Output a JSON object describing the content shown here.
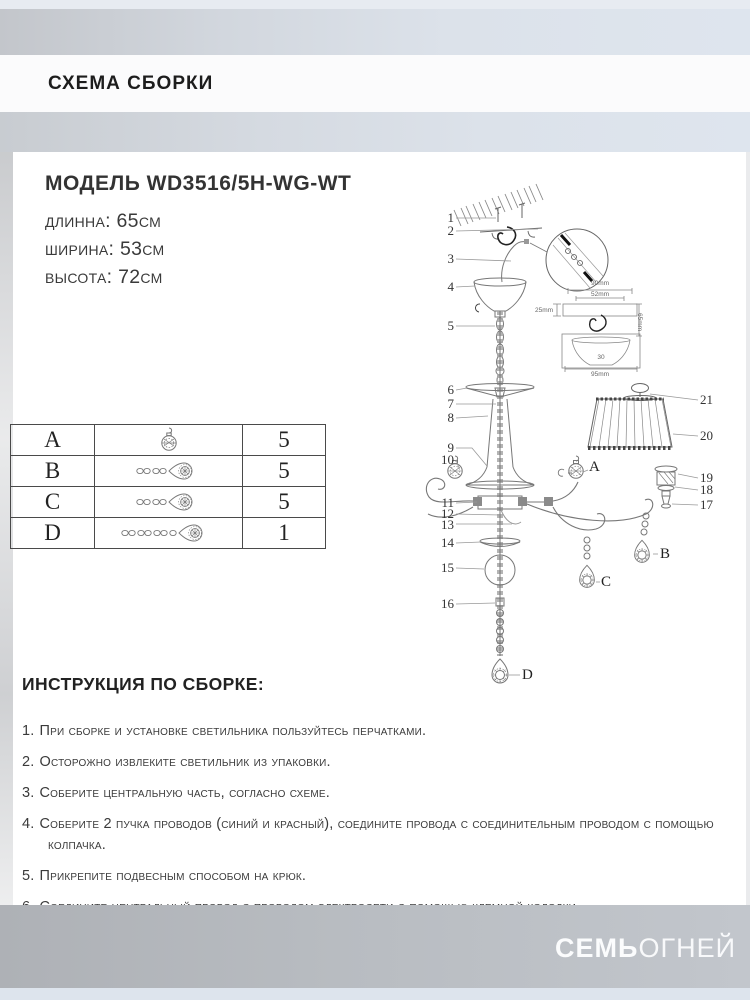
{
  "header": {
    "title": "СХЕМА СБОРКИ"
  },
  "model": {
    "title": "МОДЕЛЬ WD3516/5H-WG-WT",
    "specs": [
      "длинна: 65см",
      "ширина: 53см",
      "высота: 72см"
    ]
  },
  "parts_table": {
    "rows": [
      {
        "letter": "A",
        "icon": "crystal-ball-pendant-icon",
        "qty": "5"
      },
      {
        "letter": "B",
        "icon": "crystal-drop-short-chain-icon",
        "qty": "5"
      },
      {
        "letter": "C",
        "icon": "crystal-drop-short-chain-icon",
        "qty": "5"
      },
      {
        "letter": "D",
        "icon": "crystal-drop-long-chain-icon",
        "qty": "1"
      }
    ]
  },
  "diagram": {
    "callouts_left": [
      "1",
      "2",
      "3",
      "4",
      "5",
      "6",
      "7",
      "8",
      "9",
      "10",
      "11",
      "12",
      "13",
      "14",
      "15",
      "16"
    ],
    "callouts_right": [
      "21",
      "20",
      "19",
      "18",
      "17"
    ],
    "pendant_labels": [
      "A",
      "B",
      "C",
      "D"
    ],
    "inset": {
      "top_outer": "90mm",
      "top_inner": "52mm",
      "left": "25mm",
      "right": "65mm",
      "bottom": "95mm",
      "inner": "30"
    }
  },
  "instructions": {
    "title": "ИНСТРУКЦИЯ ПО СБОРКЕ:",
    "items": [
      {
        "num": "1.",
        "text": "При сборке и установке светильника пользуйтесь перчатками."
      },
      {
        "num": "2.",
        "text": "Осторожно извлеките светильник из упаковки."
      },
      {
        "num": "3.",
        "text": "Соберите центральную часть, согласно схеме."
      },
      {
        "num": "4.",
        "text": "Соберите 2 пучка проводов (синий и красный), соедините провода с соединительным проводом с помощью колпачка."
      },
      {
        "num": "5.",
        "text": "Прикрепите подвесным способом на крюк."
      },
      {
        "num": "6.",
        "text": "Соедините центральный провод с проводом электросети с помощью клемной колодки."
      }
    ]
  },
  "footer": {
    "brand_bold": "СЕМЬ",
    "brand_light": "ОГНЕЙ"
  }
}
